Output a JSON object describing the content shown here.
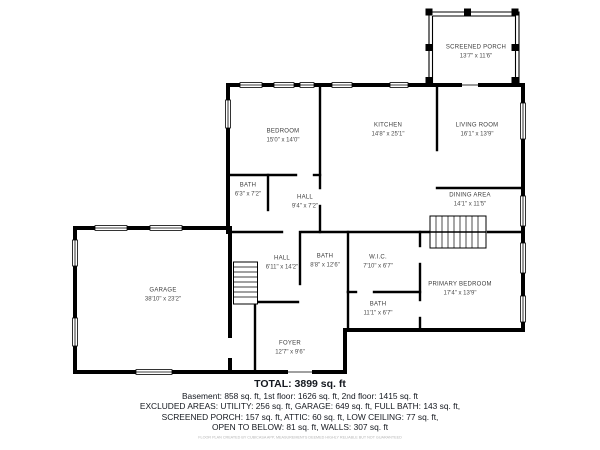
{
  "plan": {
    "rooms": [
      {
        "name": "SCREENED PORCH",
        "dims": "13'7\" x 11'6\""
      },
      {
        "name": "BEDROOM",
        "dims": "15'0\" x 14'0\""
      },
      {
        "name": "KITCHEN",
        "dims": "14'8\" x 25'1\""
      },
      {
        "name": "LIVING ROOM",
        "dims": "16'1\" x 13'9\""
      },
      {
        "name": "DINING AREA",
        "dims": "14'1\" x 11'5\""
      },
      {
        "name": "BATH",
        "dims": "6'3\" x 7'2\""
      },
      {
        "name": "HALL",
        "dims": "9'4\" x 7'2\""
      },
      {
        "name": "HALL",
        "dims": "6'11\" x 14'2\""
      },
      {
        "name": "BATH",
        "dims": "8'8\" x 12'6\""
      },
      {
        "name": "W.I.C.",
        "dims": "7'10\" x 6'7\""
      },
      {
        "name": "PRIMARY BEDROOM",
        "dims": "17'4\" x 13'9\""
      },
      {
        "name": "BATH",
        "dims": "11'1\" x 6'7\""
      },
      {
        "name": "GARAGE",
        "dims": "38'10\" x 23'2\""
      },
      {
        "name": "FOYER",
        "dims": "12'7\" x 9'6\""
      }
    ]
  },
  "summary": {
    "total": "TOTAL: 3899 sq. ft",
    "floors_line": "Basement: 858 sq. ft, 1st floor: 1626 sq. ft, 2nd floor: 1415 sq. ft",
    "excluded_line1": "EXCLUDED AREAS: UTILITY: 256 sq. ft, GARAGE: 649 sq. ft, FULL BATH: 143 sq. ft,",
    "excluded_line2": "SCREENED PORCH: 157 sq. ft, ATTIC: 60 sq. ft, LOW CEILING: 77 sq. ft,",
    "excluded_line3": "OPEN TO BELOW: 81 sq. ft, WALLS: 307 sq. ft",
    "disclaimer": "FLOOR PLAN CREATED BY CUBICASA APP, MEASUREMENTS DEEMED HIGHLY RELIABLE BUT NOT GUARANTEED"
  },
  "colors": {
    "wall": "#000000",
    "label_text": "#3d3d3d",
    "summary_text": "#14181f"
  }
}
